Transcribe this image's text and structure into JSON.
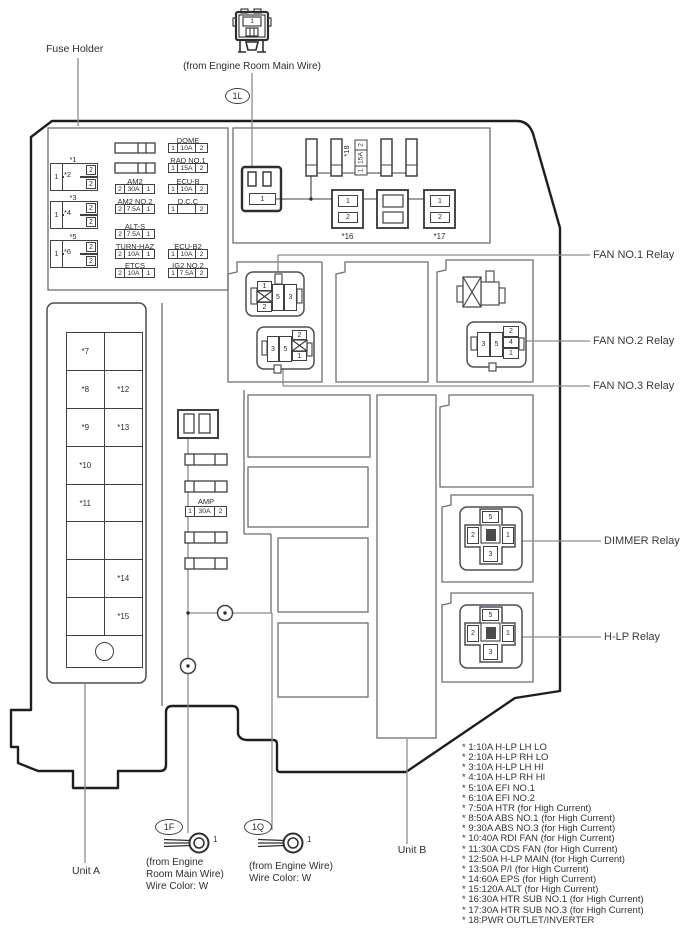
{
  "header": {
    "fuse_holder_label": "Fuse Holder",
    "top_connector_caption": "(from Engine Room Main Wire)",
    "top_connector_pin": "1",
    "connector_badge": "1L"
  },
  "fuse_table": {
    "left_blocks": [
      {
        "label_top": "*1",
        "label_mid": "*2",
        "pin": "1",
        "pin_tr": "2",
        "pin_br": "2"
      },
      {
        "label_top": "*3",
        "label_mid": "*4",
        "pin": "1",
        "pin_tr": "2",
        "pin_br": "2"
      },
      {
        "label_top": "*5",
        "label_mid": "*6",
        "pin": "1",
        "pin_tr": "2",
        "pin_br": "2"
      }
    ],
    "mid_column": [
      {
        "name": "AM2",
        "left": "2",
        "amp": "30A",
        "right": "1"
      },
      {
        "name": "AM2 NO.2",
        "left": "2",
        "amp": "7.5A",
        "right": "1"
      },
      {
        "name": "ALT-S",
        "left": "2",
        "amp": "7.5A",
        "right": "1"
      },
      {
        "name": "TURN-HAZ",
        "left": "2",
        "amp": "10A",
        "right": "1"
      },
      {
        "name": "ETCS",
        "left": "2",
        "amp": "10A",
        "right": "1"
      }
    ],
    "right_column": [
      {
        "name": "DOME",
        "left": "1",
        "amp": "10A",
        "right": "2"
      },
      {
        "name": "RAD NO.1",
        "left": "1",
        "amp": "15A",
        "right": "2"
      },
      {
        "name": "ECU-B",
        "left": "1",
        "amp": "10A",
        "right": "2"
      },
      {
        "name": "D.C.C",
        "left": "1",
        "amp": "",
        "right": "2"
      },
      {
        "name": "ECU-B2",
        "left": "1",
        "amp": "10A",
        "right": "2"
      },
      {
        "name": "IG2 NO.2",
        "left": "1",
        "amp": "7.5A",
        "right": "2"
      }
    ]
  },
  "top_section": {
    "socket_pin": "1",
    "fuse18_label": "*18",
    "fuse18": {
      "left": "1",
      "amp": "15A",
      "right": "2"
    },
    "relay16": {
      "label": "*16",
      "cell1": "1",
      "cell2": "2"
    },
    "relay17": {
      "label": "*17",
      "cell1": "1",
      "cell2": "2"
    }
  },
  "strip": {
    "rows": [
      {
        "l": "*7",
        "r": ""
      },
      {
        "l": "*8",
        "r": "*12"
      },
      {
        "l": "*9",
        "r": "*13"
      },
      {
        "l": "*10",
        "r": ""
      },
      {
        "l": "*11",
        "r": ""
      },
      {
        "l": "",
        "r": ""
      },
      {
        "l": "",
        "r": "*14"
      },
      {
        "l": "",
        "r": "*15"
      }
    ]
  },
  "amp_column": {
    "amp_label": "AMP",
    "fuse": {
      "left": "1",
      "amp": "30A",
      "right": "2"
    }
  },
  "relays": {
    "fan1": {
      "label": "FAN NO.1 Relay",
      "p1": "1",
      "p2": "2",
      "p5": "5",
      "p3": "3"
    },
    "fan2": {
      "label": "FAN NO.2 Relay",
      "p3": "3",
      "p5": "5",
      "s2": "2",
      "s4": "4",
      "s1": "1"
    },
    "fan3": {
      "label": "FAN NO.3 Relay",
      "p3": "3",
      "p5": "5",
      "s2": "2",
      "s1": "1"
    },
    "dimmer": {
      "label": "DIMMER Relay",
      "top": "5",
      "left": "2",
      "right": "1",
      "bottom": "3"
    },
    "hlp": {
      "label": "H-LP Relay",
      "top": "5",
      "left": "2",
      "right": "1",
      "bottom": "3"
    }
  },
  "bottom": {
    "unit_a": "Unit A",
    "unit_b": "Unit B",
    "t1f": {
      "badge": "1F",
      "pin": "1",
      "caption1": "(from Engine",
      "caption2": "Room Main Wire)",
      "caption3": "Wire Color: W"
    },
    "t1q": {
      "badge": "1Q",
      "pin": "1",
      "caption1": "(from Engine Wire)",
      "caption2": "Wire Color: W"
    }
  },
  "legend": {
    "items": [
      "* 1:10A H-LP LH LO",
      "* 2:10A H-LP RH LO",
      "* 3:10A H-LP LH HI",
      "* 4:10A H-LP RH HI",
      "* 5:10A EFI NO.1",
      "* 6:10A EFI NO.2",
      "* 7:50A HTR (for High Current)",
      "* 8:50A ABS NO.1 (for High Current)",
      "* 9:30A ABS NO.3 (for High Current)",
      "* 10:40A RDI FAN (for High Current)",
      "* 11:30A CDS FAN (for High Current)",
      "* 12:50A H-LP MAIN (for High Current)",
      "* 13:50A P/I (for High Current)",
      "* 14:60A EPS (for High Current)",
      "* 15:120A ALT (for High Current)",
      "* 16:30A HTR SUB NO.1 (for High Current)",
      "* 17:30A HTR SUB NO.3 (for High Current)",
      "* 18:PWR OUTLET/INVERTER"
    ]
  }
}
